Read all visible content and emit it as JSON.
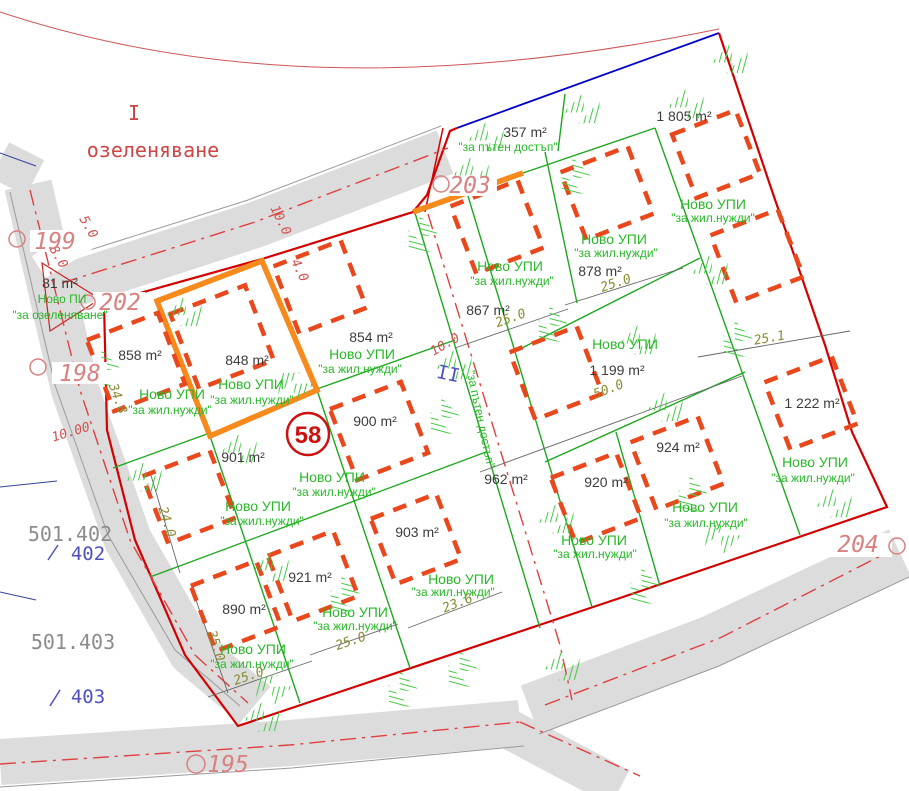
{
  "zones": {
    "numeral": "I",
    "use": "озеленяване",
    "road_numeral": "II"
  },
  "shared": {
    "novo_upi": "Ново УПИ",
    "novo_pi": "Ново ПИ",
    "res": "\"за жил.нужди\"",
    "road_access": "\"за пътен достъп\"",
    "green": "\"за озеленяване\""
  },
  "parcels": [
    {
      "area": "858 m²"
    },
    {
      "area": "848 m²",
      "highlighted": true
    },
    {
      "area": "854 m²"
    },
    {
      "area": "867 m²"
    },
    {
      "area": "878 m²"
    },
    {
      "area": "1 805 m²"
    },
    {
      "area": "1 199 m²"
    },
    {
      "area": "1 222 m²"
    },
    {
      "area": "900 m²"
    },
    {
      "area": "901 m²"
    },
    {
      "area": "890 m²"
    },
    {
      "area": "921 m²"
    },
    {
      "area": "903 m²"
    },
    {
      "area": "920 m²"
    },
    {
      "area": "924 m²"
    },
    {
      "area": "357 m²"
    },
    {
      "area": "962 m²"
    },
    {
      "area": "81 m²"
    }
  ],
  "point_labels": {
    "p199": "199",
    "p202": "202",
    "p198": "198",
    "p203": "203",
    "p204": "204",
    "p195": "195",
    "p58": "58"
  },
  "cadastre": {
    "c402": "501.402",
    "n402": "402",
    "c403": "501.403",
    "n403": "403"
  },
  "dims": {
    "d25a": "25.0",
    "d25b": "25.0",
    "d25c": "25.0",
    "d25d": "25.0",
    "d236": "23.6",
    "d50": "50.0",
    "d251": "25.1",
    "d348": "34.8",
    "d240": "24.0",
    "d350": "35.0",
    "d10a": "10.0",
    "d40": "4.0",
    "d10b": "10.0",
    "d1000": "10.00",
    "d50s": "5.0",
    "d80": "8.0"
  },
  "colors": {
    "boundary": "#d40000",
    "parcel_line": "#1ea81e",
    "building": "#e8481c",
    "highlight": "#f78a1d",
    "road_fill": "#dcdcdc",
    "axis": "#e04040",
    "label_green": "#28b828",
    "dim": "#8a8a33",
    "blue": "#0000cc"
  }
}
